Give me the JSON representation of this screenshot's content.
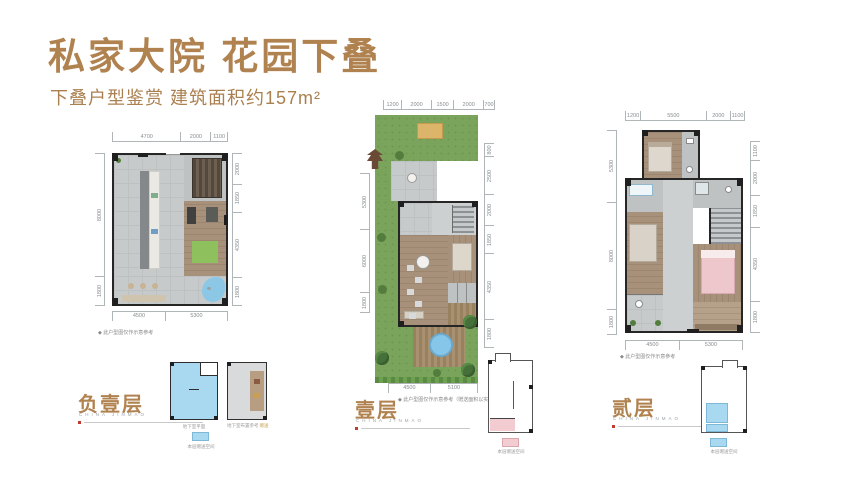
{
  "header": {
    "title": "私家大院 花园下叠",
    "subtitle": "下叠户型鉴赏  建筑面积约157m²"
  },
  "plans": [
    {
      "label": "负壹层",
      "brand": "CHINA JINMAO",
      "note": "◆ 此户型图仅作示意参考",
      "dims_top": [
        "4700",
        "2000",
        "1100"
      ],
      "dims_left": [
        "8000",
        "1800"
      ],
      "dims_right": [
        "2000",
        "1850",
        "4350",
        "1800"
      ],
      "dims_bottom": [
        "4500",
        "5300"
      ]
    },
    {
      "label": "壹层",
      "brand": "CHINA JINMAO",
      "note": "◆ 此户型图仅作示意参考（赠送面积以实际交付为准）",
      "dims_top": [
        "1200",
        "2000",
        "1500",
        "2000",
        "700"
      ],
      "dims_left": [
        "5300",
        "6000",
        "1800"
      ],
      "dims_right": [
        "800",
        "2500",
        "2000",
        "1850",
        "4350",
        "1800"
      ],
      "dims_bottom": [
        "4500",
        "5100"
      ]
    },
    {
      "label": "贰层",
      "brand": "CHINA JINMAO",
      "note": "◆ 此户型图仅作示意参考",
      "dims_top": [
        "1200",
        "5500",
        "2000",
        "1100"
      ],
      "dims_left": [
        "5300",
        "8000",
        "1800"
      ],
      "dims_right": [
        "1100",
        "2000",
        "1850",
        "4350",
        "1800"
      ],
      "dims_bottom": [
        "4500",
        "5300"
      ]
    }
  ],
  "insets": {
    "basement_plan_caption": "地下室平面",
    "basement_legend": "本层赠送空间",
    "basement_ref_caption": "地下室布置参考",
    "basement_ref_tag": "赠送",
    "first_legend": "本层赠送空间",
    "second_legend": "本层赠送空间"
  },
  "colors": {
    "accent_gold": "#b0824f",
    "brand_gray": "#9aa0a6",
    "dim_gray": "#878d90",
    "wall_black": "#262626",
    "garden_green": "#7aa45c",
    "water_blue": "#86c6e8",
    "highlight_blue": "#a9d9f0",
    "highlight_pink": "#f3ccd2",
    "wood_brown": "#a8917a",
    "tile_gray": "#c7cacb",
    "marker_red": "#c13a30"
  }
}
